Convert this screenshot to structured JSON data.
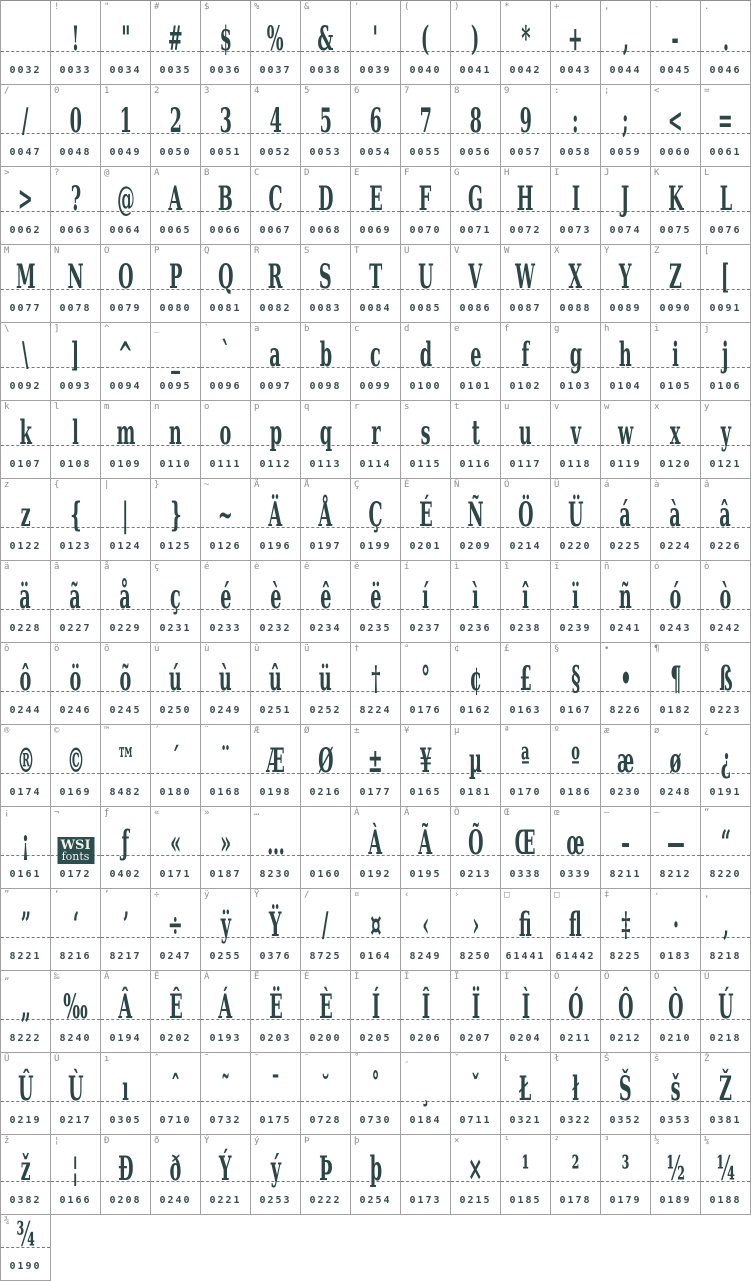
{
  "colors": {
    "glyph": "#2c4646",
    "label": "#8f8f8f",
    "code": "#3d4c4c",
    "grid_border": "#a2a2a2",
    "baseline_dash": "#7a7a7a",
    "logo_background": "#2e4d4d",
    "logo_text": "#eef2ee",
    "background": "#ffffff"
  },
  "logo": {
    "line1": "WSI",
    "line2": "fonts"
  },
  "rows": [
    {
      "cells": [
        {
          "l": "",
          "g": "",
          "c": "0032"
        },
        {
          "l": "!",
          "g": "!",
          "c": "0033"
        },
        {
          "l": "\"",
          "g": "\"",
          "c": "0034"
        },
        {
          "l": "#",
          "g": "#",
          "c": "0035"
        },
        {
          "l": "$",
          "g": "$",
          "c": "0036"
        },
        {
          "l": "%",
          "g": "%",
          "c": "0037"
        },
        {
          "l": "&",
          "g": "&",
          "c": "0038"
        },
        {
          "l": "'",
          "g": "'",
          "c": "0039"
        },
        {
          "l": "(",
          "g": "(",
          "c": "0040"
        },
        {
          "l": ")",
          "g": ")",
          "c": "0041"
        },
        {
          "l": "*",
          "g": "*",
          "c": "0042"
        },
        {
          "l": "+",
          "g": "+",
          "c": "0043"
        },
        {
          "l": ",",
          "g": ",",
          "c": "0044"
        },
        {
          "l": "-",
          "g": "-",
          "c": "0045"
        },
        {
          "l": ".",
          "g": ".",
          "c": "0046"
        }
      ]
    },
    {
      "cells": [
        {
          "l": "/",
          "g": "/",
          "c": "0047"
        },
        {
          "l": "0",
          "g": "0",
          "c": "0048"
        },
        {
          "l": "1",
          "g": "1",
          "c": "0049"
        },
        {
          "l": "2",
          "g": "2",
          "c": "0050"
        },
        {
          "l": "3",
          "g": "3",
          "c": "0051"
        },
        {
          "l": "4",
          "g": "4",
          "c": "0052"
        },
        {
          "l": "5",
          "g": "5",
          "c": "0053"
        },
        {
          "l": "6",
          "g": "6",
          "c": "0054"
        },
        {
          "l": "7",
          "g": "7",
          "c": "0055"
        },
        {
          "l": "8",
          "g": "8",
          "c": "0056"
        },
        {
          "l": "9",
          "g": "9",
          "c": "0057"
        },
        {
          "l": ":",
          "g": ":",
          "c": "0058"
        },
        {
          "l": ";",
          "g": ";",
          "c": "0059"
        },
        {
          "l": "<",
          "g": "<",
          "c": "0060"
        },
        {
          "l": "=",
          "g": "=",
          "c": "0061"
        }
      ]
    },
    {
      "cells": [
        {
          "l": ">",
          "g": ">",
          "c": "0062"
        },
        {
          "l": "?",
          "g": "?",
          "c": "0063"
        },
        {
          "l": "@",
          "g": "@",
          "c": "0064"
        },
        {
          "l": "A",
          "g": "A",
          "c": "0065"
        },
        {
          "l": "B",
          "g": "B",
          "c": "0066"
        },
        {
          "l": "C",
          "g": "C",
          "c": "0067"
        },
        {
          "l": "D",
          "g": "D",
          "c": "0068"
        },
        {
          "l": "E",
          "g": "E",
          "c": "0069"
        },
        {
          "l": "F",
          "g": "F",
          "c": "0070"
        },
        {
          "l": "G",
          "g": "G",
          "c": "0071"
        },
        {
          "l": "H",
          "g": "H",
          "c": "0072"
        },
        {
          "l": "I",
          "g": "I",
          "c": "0073"
        },
        {
          "l": "J",
          "g": "J",
          "c": "0074"
        },
        {
          "l": "K",
          "g": "K",
          "c": "0075"
        },
        {
          "l": "L",
          "g": "L",
          "c": "0076"
        }
      ]
    },
    {
      "cells": [
        {
          "l": "M",
          "g": "M",
          "c": "0077"
        },
        {
          "l": "N",
          "g": "N",
          "c": "0078"
        },
        {
          "l": "O",
          "g": "O",
          "c": "0079"
        },
        {
          "l": "P",
          "g": "P",
          "c": "0080"
        },
        {
          "l": "Q",
          "g": "Q",
          "c": "0081"
        },
        {
          "l": "R",
          "g": "R",
          "c": "0082"
        },
        {
          "l": "S",
          "g": "S",
          "c": "0083"
        },
        {
          "l": "T",
          "g": "T",
          "c": "0084"
        },
        {
          "l": "U",
          "g": "U",
          "c": "0085"
        },
        {
          "l": "V",
          "g": "V",
          "c": "0086"
        },
        {
          "l": "W",
          "g": "W",
          "c": "0087"
        },
        {
          "l": "X",
          "g": "X",
          "c": "0088"
        },
        {
          "l": "Y",
          "g": "Y",
          "c": "0089"
        },
        {
          "l": "Z",
          "g": "Z",
          "c": "0090"
        },
        {
          "l": "[",
          "g": "[",
          "c": "0091"
        }
      ]
    },
    {
      "cells": [
        {
          "l": "\\",
          "g": "\\",
          "c": "0092"
        },
        {
          "l": "]",
          "g": "]",
          "c": "0093"
        },
        {
          "l": "^",
          "g": "^",
          "c": "0094"
        },
        {
          "l": "_",
          "g": "_",
          "c": "0095"
        },
        {
          "l": "`",
          "g": "`",
          "c": "0096"
        },
        {
          "l": "a",
          "g": "a",
          "c": "0097"
        },
        {
          "l": "b",
          "g": "b",
          "c": "0098"
        },
        {
          "l": "c",
          "g": "c",
          "c": "0099"
        },
        {
          "l": "d",
          "g": "d",
          "c": "0100"
        },
        {
          "l": "e",
          "g": "e",
          "c": "0101"
        },
        {
          "l": "f",
          "g": "f",
          "c": "0102"
        },
        {
          "l": "g",
          "g": "g",
          "c": "0103"
        },
        {
          "l": "h",
          "g": "h",
          "c": "0104"
        },
        {
          "l": "i",
          "g": "i",
          "c": "0105"
        },
        {
          "l": "j",
          "g": "j",
          "c": "0106"
        }
      ]
    },
    {
      "cells": [
        {
          "l": "k",
          "g": "k",
          "c": "0107"
        },
        {
          "l": "l",
          "g": "l",
          "c": "0108"
        },
        {
          "l": "m",
          "g": "m",
          "c": "0109"
        },
        {
          "l": "n",
          "g": "n",
          "c": "0110"
        },
        {
          "l": "o",
          "g": "o",
          "c": "0111"
        },
        {
          "l": "p",
          "g": "p",
          "c": "0112"
        },
        {
          "l": "q",
          "g": "q",
          "c": "0113"
        },
        {
          "l": "r",
          "g": "r",
          "c": "0114"
        },
        {
          "l": "s",
          "g": "s",
          "c": "0115"
        },
        {
          "l": "t",
          "g": "t",
          "c": "0116"
        },
        {
          "l": "u",
          "g": "u",
          "c": "0117"
        },
        {
          "l": "v",
          "g": "v",
          "c": "0118"
        },
        {
          "l": "w",
          "g": "w",
          "c": "0119"
        },
        {
          "l": "x",
          "g": "x",
          "c": "0120"
        },
        {
          "l": "y",
          "g": "y",
          "c": "0121"
        }
      ]
    },
    {
      "cells": [
        {
          "l": "z",
          "g": "z",
          "c": "0122"
        },
        {
          "l": "{",
          "g": "{",
          "c": "0123"
        },
        {
          "l": "|",
          "g": "|",
          "c": "0124"
        },
        {
          "l": "}",
          "g": "}",
          "c": "0125"
        },
        {
          "l": "~",
          "g": "~",
          "c": "0126"
        },
        {
          "l": "Ä",
          "g": "Ä",
          "c": "0196"
        },
        {
          "l": "Å",
          "g": "Å",
          "c": "0197"
        },
        {
          "l": "Ç",
          "g": "Ç",
          "c": "0199"
        },
        {
          "l": "É",
          "g": "É",
          "c": "0201"
        },
        {
          "l": "Ñ",
          "g": "Ñ",
          "c": "0209"
        },
        {
          "l": "Ö",
          "g": "Ö",
          "c": "0214"
        },
        {
          "l": "Ü",
          "g": "Ü",
          "c": "0220"
        },
        {
          "l": "á",
          "g": "á",
          "c": "0225"
        },
        {
          "l": "à",
          "g": "à",
          "c": "0224"
        },
        {
          "l": "â",
          "g": "â",
          "c": "0226"
        }
      ]
    },
    {
      "cells": [
        {
          "l": "ä",
          "g": "ä",
          "c": "0228"
        },
        {
          "l": "ã",
          "g": "ã",
          "c": "0227"
        },
        {
          "l": "å",
          "g": "å",
          "c": "0229"
        },
        {
          "l": "ç",
          "g": "ç",
          "c": "0231"
        },
        {
          "l": "é",
          "g": "é",
          "c": "0233"
        },
        {
          "l": "è",
          "g": "è",
          "c": "0232"
        },
        {
          "l": "ê",
          "g": "ê",
          "c": "0234"
        },
        {
          "l": "ë",
          "g": "ë",
          "c": "0235"
        },
        {
          "l": "í",
          "g": "í",
          "c": "0237"
        },
        {
          "l": "ì",
          "g": "ì",
          "c": "0236"
        },
        {
          "l": "î",
          "g": "î",
          "c": "0238"
        },
        {
          "l": "ï",
          "g": "ï",
          "c": "0239"
        },
        {
          "l": "ñ",
          "g": "ñ",
          "c": "0241"
        },
        {
          "l": "ó",
          "g": "ó",
          "c": "0243"
        },
        {
          "l": "ò",
          "g": "ò",
          "c": "0242"
        }
      ]
    },
    {
      "cells": [
        {
          "l": "ô",
          "g": "ô",
          "c": "0244"
        },
        {
          "l": "ö",
          "g": "ö",
          "c": "0246"
        },
        {
          "l": "õ",
          "g": "õ",
          "c": "0245"
        },
        {
          "l": "ú",
          "g": "ú",
          "c": "0250"
        },
        {
          "l": "ù",
          "g": "ù",
          "c": "0249"
        },
        {
          "l": "û",
          "g": "û",
          "c": "0251"
        },
        {
          "l": "ü",
          "g": "ü",
          "c": "0252"
        },
        {
          "l": "†",
          "g": "†",
          "c": "8224"
        },
        {
          "l": "°",
          "g": "°",
          "c": "0176"
        },
        {
          "l": "¢",
          "g": "¢",
          "c": "0162"
        },
        {
          "l": "£",
          "g": "£",
          "c": "0163"
        },
        {
          "l": "§",
          "g": "§",
          "c": "0167"
        },
        {
          "l": "•",
          "g": "•",
          "c": "8226"
        },
        {
          "l": "¶",
          "g": "¶",
          "c": "0182"
        },
        {
          "l": "ß",
          "g": "ß",
          "c": "0223"
        }
      ]
    },
    {
      "cells": [
        {
          "l": "®",
          "g": "®",
          "c": "0174"
        },
        {
          "l": "©",
          "g": "©",
          "c": "0169"
        },
        {
          "l": "™",
          "g": "™",
          "c": "8482"
        },
        {
          "l": "´",
          "g": "´",
          "c": "0180"
        },
        {
          "l": "¨",
          "g": "¨",
          "c": "0168"
        },
        {
          "l": "Æ",
          "g": "Æ",
          "c": "0198"
        },
        {
          "l": "Ø",
          "g": "Ø",
          "c": "0216"
        },
        {
          "l": "±",
          "g": "±",
          "c": "0177"
        },
        {
          "l": "¥",
          "g": "¥",
          "c": "0165"
        },
        {
          "l": "µ",
          "g": "µ",
          "c": "0181"
        },
        {
          "l": "ª",
          "g": "ª",
          "c": "0170"
        },
        {
          "l": "º",
          "g": "º",
          "c": "0186"
        },
        {
          "l": "æ",
          "g": "æ",
          "c": "0230"
        },
        {
          "l": "ø",
          "g": "ø",
          "c": "0248"
        },
        {
          "l": "¿",
          "g": "¿",
          "c": "0191"
        }
      ]
    },
    {
      "cells": [
        {
          "l": "¡",
          "g": "¡",
          "c": "0161"
        },
        {
          "l": "¬",
          "g": "",
          "c": "0172",
          "logo": true
        },
        {
          "l": "ƒ",
          "g": "ƒ",
          "c": "0402"
        },
        {
          "l": "«",
          "g": "«",
          "c": "0171"
        },
        {
          "l": "»",
          "g": "»",
          "c": "0187"
        },
        {
          "l": "…",
          "g": "…",
          "c": "8230"
        },
        {
          "l": "",
          "g": "",
          "c": "0160"
        },
        {
          "l": "À",
          "g": "À",
          "c": "0192"
        },
        {
          "l": "Ã",
          "g": "Ã",
          "c": "0195"
        },
        {
          "l": "Õ",
          "g": "Õ",
          "c": "0213"
        },
        {
          "l": "Œ",
          "g": "Œ",
          "c": "0338"
        },
        {
          "l": "œ",
          "g": "œ",
          "c": "0339"
        },
        {
          "l": "–",
          "g": "–",
          "c": "8211"
        },
        {
          "l": "—",
          "g": "—",
          "c": "8212"
        },
        {
          "l": "“",
          "g": "“",
          "c": "8220"
        }
      ]
    },
    {
      "cells": [
        {
          "l": "”",
          "g": "”",
          "c": "8221"
        },
        {
          "l": "‘",
          "g": "‘",
          "c": "8216"
        },
        {
          "l": "’",
          "g": "’",
          "c": "8217"
        },
        {
          "l": "÷",
          "g": "÷",
          "c": "0247"
        },
        {
          "l": "ÿ",
          "g": "ÿ",
          "c": "0255"
        },
        {
          "l": "Ÿ",
          "g": "Ÿ",
          "c": "0376"
        },
        {
          "l": "∕",
          "g": "∕",
          "c": "8725"
        },
        {
          "l": "¤",
          "g": "¤",
          "c": "0164"
        },
        {
          "l": "‹",
          "g": "‹",
          "c": "8249"
        },
        {
          "l": "›",
          "g": "›",
          "c": "8250"
        },
        {
          "l": "□",
          "g": "ﬁ",
          "c": "61441"
        },
        {
          "l": "□",
          "g": "ﬂ",
          "c": "61442"
        },
        {
          "l": "‡",
          "g": "‡",
          "c": "8225"
        },
        {
          "l": "·",
          "g": "·",
          "c": "0183"
        },
        {
          "l": "‚",
          "g": "‚",
          "c": "8218"
        }
      ]
    },
    {
      "cells": [
        {
          "l": "„",
          "g": "„",
          "c": "8222"
        },
        {
          "l": "‰",
          "g": "‰",
          "c": "8240"
        },
        {
          "l": "Â",
          "g": "Â",
          "c": "0194"
        },
        {
          "l": "Ê",
          "g": "Ê",
          "c": "0202"
        },
        {
          "l": "Á",
          "g": "Á",
          "c": "0193"
        },
        {
          "l": "Ë",
          "g": "Ë",
          "c": "0203"
        },
        {
          "l": "È",
          "g": "È",
          "c": "0200"
        },
        {
          "l": "Í",
          "g": "Í",
          "c": "0205"
        },
        {
          "l": "Î",
          "g": "Î",
          "c": "0206"
        },
        {
          "l": "Ï",
          "g": "Ï",
          "c": "0207"
        },
        {
          "l": "Ì",
          "g": "Ì",
          "c": "0204"
        },
        {
          "l": "Ó",
          "g": "Ó",
          "c": "0211"
        },
        {
          "l": "Ô",
          "g": "Ô",
          "c": "0212"
        },
        {
          "l": "Ò",
          "g": "Ò",
          "c": "0210"
        },
        {
          "l": "Ú",
          "g": "Ú",
          "c": "0218"
        }
      ]
    },
    {
      "cells": [
        {
          "l": "Û",
          "g": "Û",
          "c": "0219"
        },
        {
          "l": "Ù",
          "g": "Ù",
          "c": "0217"
        },
        {
          "l": "ı",
          "g": "ı",
          "c": "0305"
        },
        {
          "l": "ˆ",
          "g": "ˆ",
          "c": "0710"
        },
        {
          "l": "˜",
          "g": "˜",
          "c": "0732"
        },
        {
          "l": "¯",
          "g": "¯",
          "c": "0175"
        },
        {
          "l": "˘",
          "g": "˘",
          "c": "0728"
        },
        {
          "l": "˚",
          "g": "˚",
          "c": "0730"
        },
        {
          "l": "¸",
          "g": "¸",
          "c": "0184"
        },
        {
          "l": "ˇ",
          "g": "ˇ",
          "c": "0711"
        },
        {
          "l": "Ł",
          "g": "Ł",
          "c": "0321"
        },
        {
          "l": "ł",
          "g": "ł",
          "c": "0322"
        },
        {
          "l": "Š",
          "g": "Š",
          "c": "0352"
        },
        {
          "l": "š",
          "g": "š",
          "c": "0353"
        },
        {
          "l": "Ž",
          "g": "Ž",
          "c": "0381"
        }
      ]
    },
    {
      "cells": [
        {
          "l": "ž",
          "g": "ž",
          "c": "0382"
        },
        {
          "l": "¦",
          "g": "¦",
          "c": "0166"
        },
        {
          "l": "Ð",
          "g": "Ð",
          "c": "0208"
        },
        {
          "l": "ð",
          "g": "ð",
          "c": "0240"
        },
        {
          "l": "Ý",
          "g": "Ý",
          "c": "0221"
        },
        {
          "l": "ý",
          "g": "ý",
          "c": "0253"
        },
        {
          "l": "Þ",
          "g": "Þ",
          "c": "0222"
        },
        {
          "l": "þ",
          "g": "þ",
          "c": "0254"
        },
        {
          "l": "",
          "g": "",
          "c": "0173"
        },
        {
          "l": "×",
          "g": "×",
          "c": "0215"
        },
        {
          "l": "¹",
          "g": "¹",
          "c": "0185"
        },
        {
          "l": "²",
          "g": "²",
          "c": "0178"
        },
        {
          "l": "³",
          "g": "³",
          "c": "0179"
        },
        {
          "l": "½",
          "g": "½",
          "c": "0189"
        },
        {
          "l": "¼",
          "g": "¼",
          "c": "0188"
        }
      ]
    },
    {
      "cells": [
        {
          "l": "¾",
          "g": "¾",
          "c": "0190"
        }
      ]
    }
  ]
}
